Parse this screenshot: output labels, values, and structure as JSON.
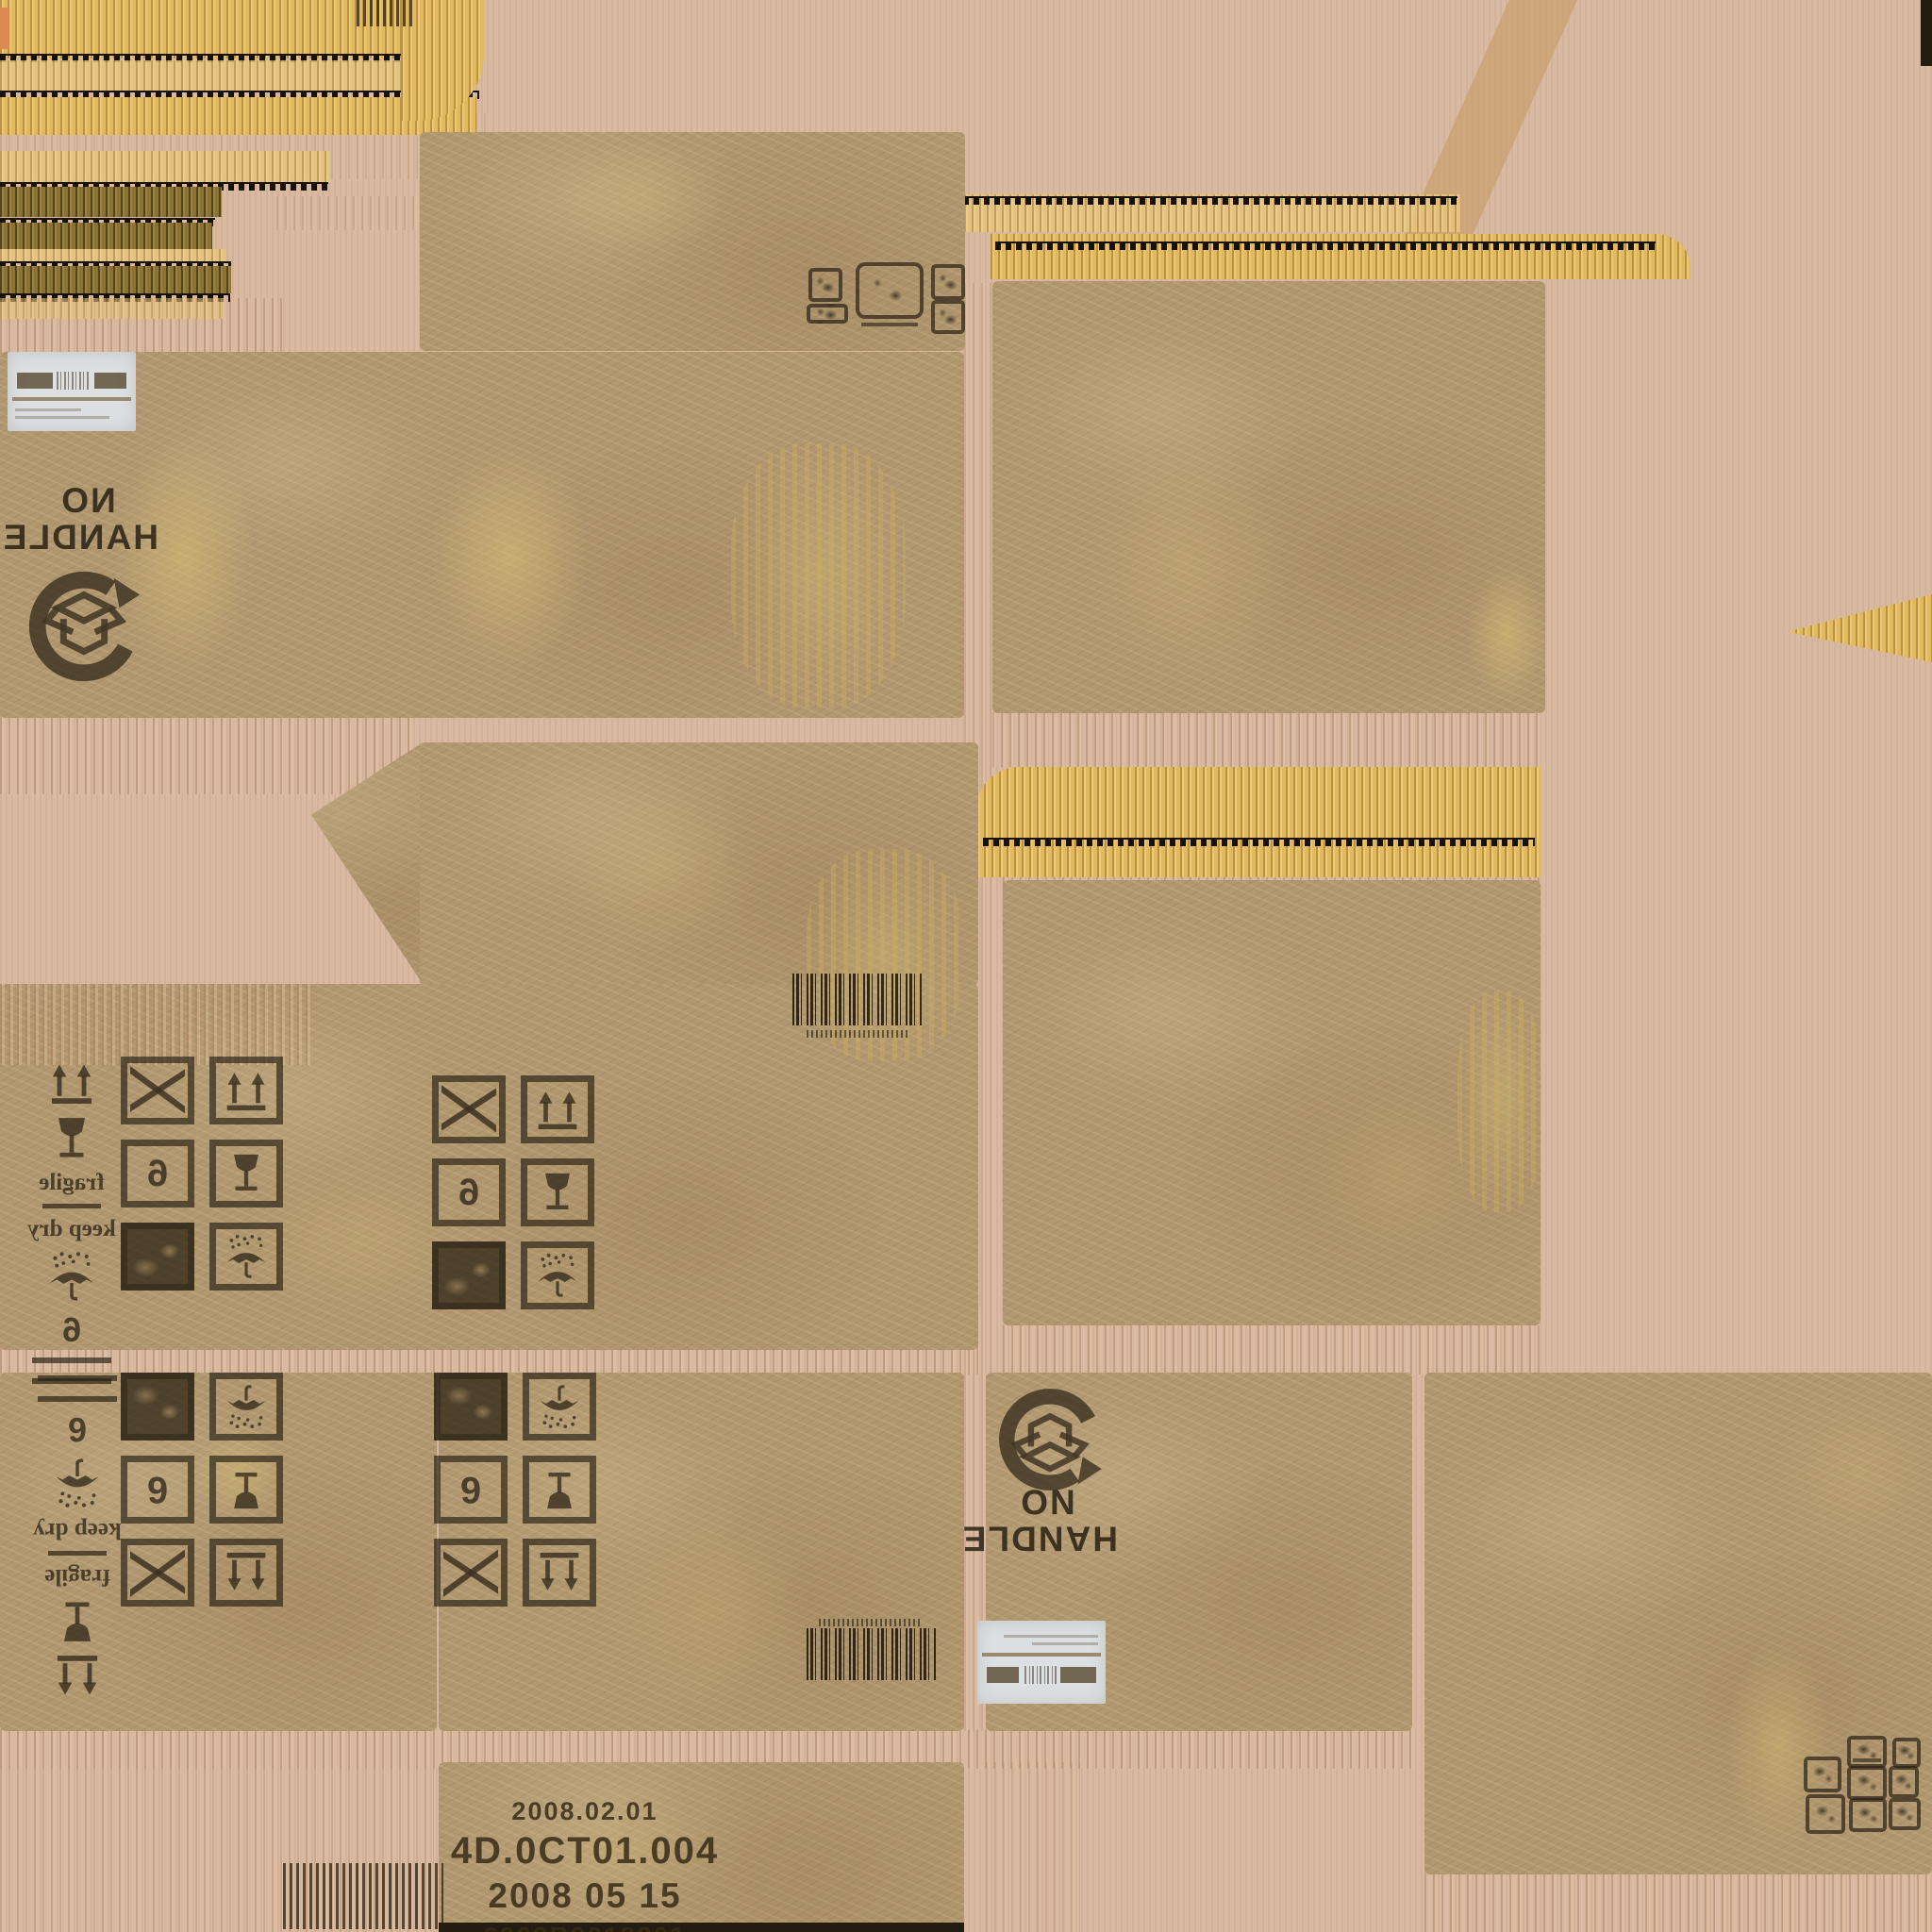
{
  "palette": {
    "background": "#d9b9a1",
    "cardboard": "#b1976f",
    "corrugate_gold": "#e2b95e",
    "corrugate_dark": "#8a7233",
    "corrugate_line": "#171106",
    "stamp_ink": "#28201a",
    "label_white": "#dde0e3",
    "stain_yellow": "#d8c176",
    "print_ink": "#3a2d1a"
  },
  "stamps": {
    "no_handle_top": {
      "line1": "NO",
      "line2": "HANDLE",
      "orientation": "mirrored"
    },
    "no_handle_bottom": {
      "line1": "NO",
      "line2": "HANDLE",
      "orientation": "rotated-180"
    },
    "fragile": "fragile",
    "keep_dry": "keep dry",
    "stack_limit": "6",
    "print_codes": [
      "2008.02.01",
      "4D.0CT01.004",
      "2008 05 15",
      "6062B0013201"
    ]
  },
  "icons": {
    "handling_stamp": "open-box-circular-arrow-stamp",
    "this_way_up": "this-way-up-arrows-icon",
    "fragile_glass": "fragile-wine-glass-icon",
    "keep_dry_umbrella": "keep-dry-umbrella-icon",
    "crossed_box": "crossed-out-box-icon",
    "ink_patch": "solid-ink-patch",
    "barcode": "barcode-stamp",
    "shipping_label": "shipping-label",
    "mini_pictograms": "small-warning-pictogram-cluster"
  }
}
